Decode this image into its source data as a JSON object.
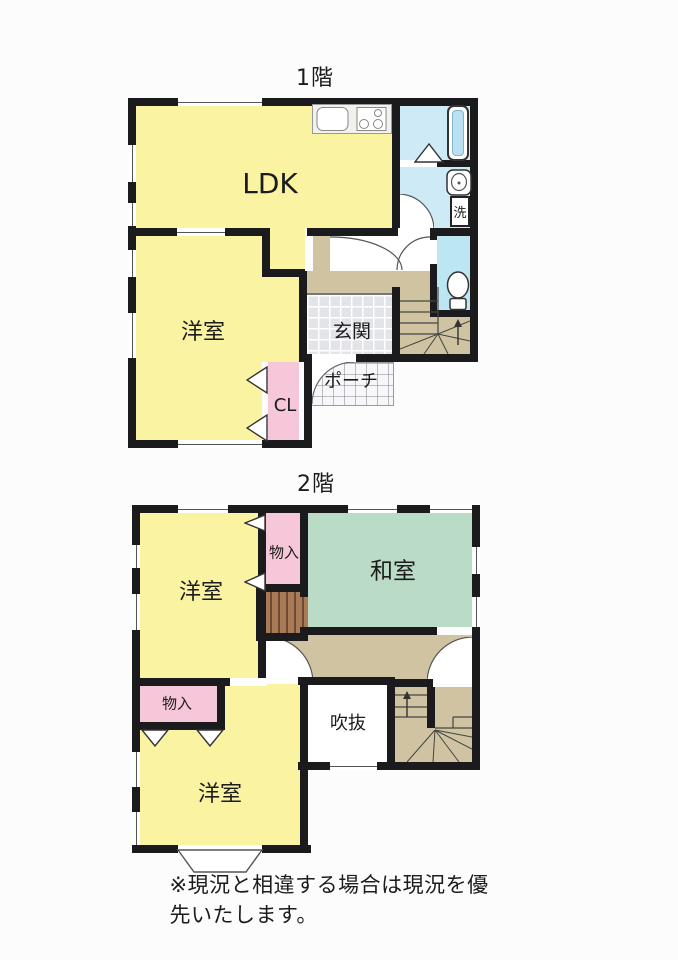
{
  "page": {
    "background": "#fcfcfc",
    "note": "※現況と相違する場合は現況を優先いたします。"
  },
  "floor1": {
    "title": "1階",
    "rooms": {
      "ldk": "LDK",
      "bedroom": "洋室",
      "genkan": "玄関",
      "porch": "ポーチ",
      "closet": "CL",
      "laundry": "洗"
    }
  },
  "floor2": {
    "title": "2階",
    "rooms": {
      "bedroom_top": "洋室",
      "storage_top": "物入",
      "washitsu": "和室",
      "storage_bottom": "物入",
      "void": "吹抜",
      "bedroom_bottom": "洋室"
    }
  },
  "icons": [
    "bathtub-icon",
    "toilet-icon",
    "washbasin-icon",
    "kitchen-sink-icon",
    "stove-icon",
    "stairs-up-arrow-icon",
    "door-swing-arc-icon",
    "folding-door-triangle-icon",
    "bay-window-icon"
  ],
  "colors": {
    "wall": "#1b1b1d",
    "room_yellow": "#f9f3a2",
    "room_green": "#badcc7",
    "room_pink": "#f6c7d8",
    "hall_tan": "#cfc3a2",
    "water_cyan": "#cdeaf6",
    "toilet_cyan": "#bde6f3",
    "tub_fill": "#b9e1f1",
    "genkan_tile": "#e3e3ea",
    "wood_brown": "#a87a56"
  }
}
